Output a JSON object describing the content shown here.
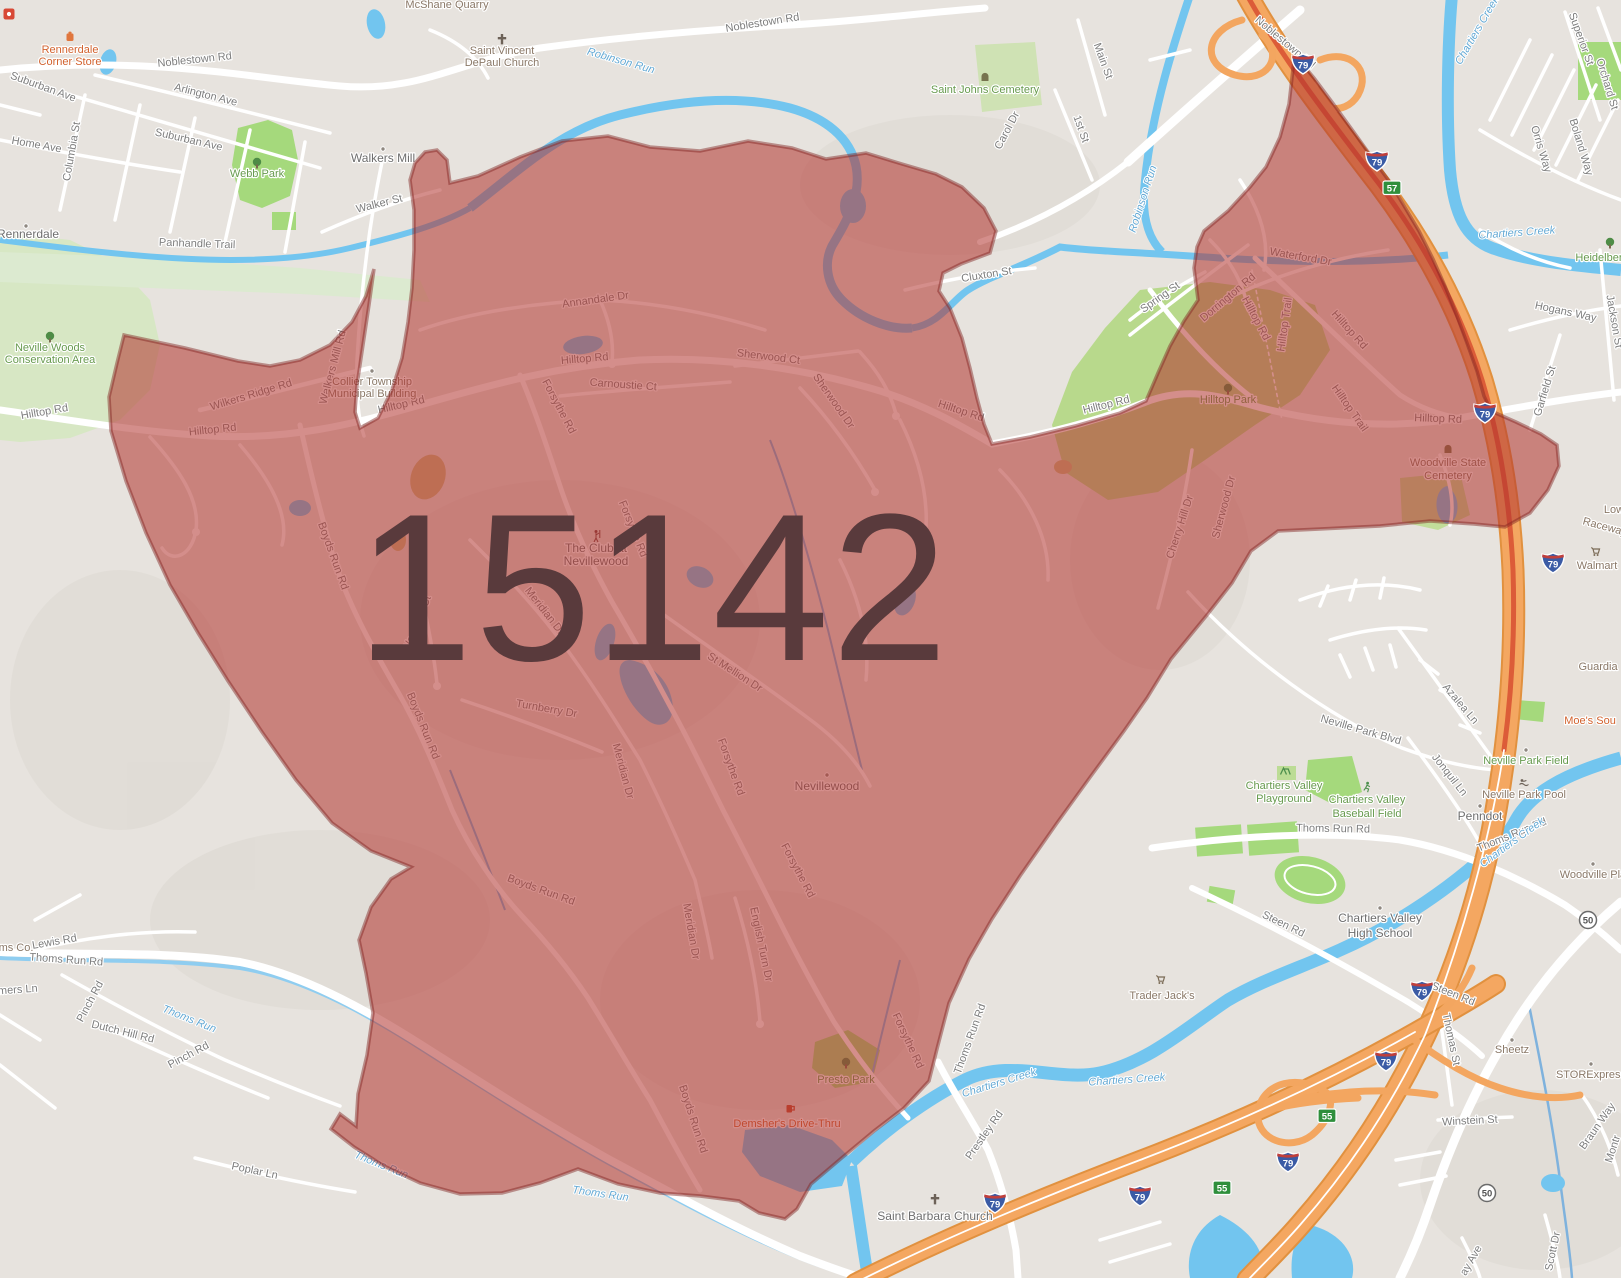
{
  "zip": {
    "code": "15142"
  },
  "colors": {
    "overlay_fill": "#b23531",
    "overlay_border": "#7e221f",
    "zip_text": "#593a3c",
    "highway_orange": "#f4a761",
    "water_blue": "#72c5ef",
    "park_green": "#a5d97c",
    "land": "#e7e3de"
  },
  "labels": {
    "shields": {
      "i79": "79",
      "exit57": "57",
      "exit55": "55",
      "route50": "50"
    },
    "roads": {
      "noblestown_w": "Noblestown Rd",
      "noblestown_c": "Noblestown Rd",
      "noblestown_ne": "Noblestown Rd",
      "arlington": "Arlington Ave",
      "suburban_1": "Suburban Ave",
      "suburban_2": "Suburban Ave",
      "home": "Home Ave",
      "columbia": "Columbia St",
      "walker": "Walker St",
      "panhandle": "Panhandle Trail",
      "carol": "Carol Dr",
      "cluxton": "Cluxton St",
      "main": "Main St",
      "first": "1st St",
      "spring": "Spring St",
      "dorrington": "Dorrington Rd",
      "superior": "Superior St",
      "orchard": "Orchard St",
      "orris": "Orris Way",
      "boland": "Boland Way",
      "hogans": "Hogans Way",
      "jackson": "Jackson St",
      "garfield": "Garfield St",
      "hilltop_w_out": "Hilltop Rd",
      "hilltop_w_in": "Hilltop Rd",
      "hilltop_mid1": "Hilltop Rd",
      "hilltop_c": "Hilltop Rd",
      "hilltop_in_e": "Hilltop Rd",
      "hilltop_notch": "Hilltop Rd",
      "hilltop_vert": "Hilltop Rd",
      "hilltop_ne_diag": "Hilltop Rd",
      "hilltop_e": "Hilltop Rd",
      "hilltop_trail_1": "Hilltop Trail",
      "hilltop_trail_2": "Hilltop Trail",
      "wilkers": "Wilkers Ridge Rd",
      "walkers_mill_rd": "Walkers Mill Rd",
      "annandale": "Annandale Dr",
      "carnoustie": "Carnoustie Ct",
      "sherwood_ct": "Sherwood Ct",
      "sherwood_dr_1": "Sherwood Dr",
      "sherwood_dr_2": "Sherwood Dr",
      "cherry_hill": "Cherry Hill Dr",
      "forsythe_1": "Forsythe Rd",
      "forsythe_2": "Forsythe Rd",
      "forsythe_3": "Forsythe Rd",
      "forsythe_4": "Forsythe Rd",
      "forsythe_5": "Forsythe Rd",
      "boyds_1": "Boyds Run Rd",
      "boyds_2": "Boyds Run Rd",
      "boyds_3": "Boyds Run Rd",
      "boyds_4": "Boyds Run Rd",
      "meridian_1": "Meridian Dr",
      "meridian_2": "Meridian Dr",
      "meridian_3": "Meridian Dr",
      "turnberry": "Turnberry Dr",
      "st_mellion": "St Mellion Dr",
      "woodhall": "Woodhall Ct",
      "english_turn": "English Turn Dr",
      "waterford": "Waterford Dr",
      "neville_park_blvd": "Neville Park Blvd",
      "azalea": "Azalea Ln",
      "jonquil": "Jonquil Ln",
      "thoms_run_rd_w": "Thoms Run Rd",
      "thoms_run_rd_s": "Thoms Run Rd",
      "thoms_run_rd_c": "Thoms Run Rd",
      "thoms_run_rd_e": "Thoms Run Rd",
      "prestley": "Prestley Rd",
      "lewis": "Lewis Rd",
      "pinch_1": "Pinch Rd",
      "pinch_2": "Pinch Rd",
      "dutch_hill": "Dutch Hill Rd",
      "poplar": "Poplar Ln",
      "mers_ln": "mers Ln",
      "steen_1": "Steen Rd",
      "steen_2": "Steen Rd",
      "thomas": "Thomas St",
      "winstein": "Winstein St",
      "braun": "Braun Way",
      "scott": "Scott Dr",
      "ay_ave": "ay Ave",
      "montr": "Montr"
    },
    "water": {
      "robinson_1": "Robinson Run",
      "robinson_2": "Robinson Run",
      "chartiers_1": "Chartiers Creek",
      "chartiers_2": "Chartiers Creek",
      "chartiers_3": "Chartiers Creek",
      "chartiers_4": "Chartiers Creek",
      "chartiers_5": "Chartiers Creek",
      "thoms_1": "Thoms Run",
      "thoms_2": "Thoms Run",
      "thoms_3": "Thoms Run"
    },
    "places": {
      "rennerdale": "Rennerdale",
      "walkers_mill": "Walkers Mill",
      "nevillewood": "Nevillewood",
      "penndot": "Penndot",
      "cv_hs_1": "Chartiers Valley",
      "cv_hs_2": "High School",
      "st_barbara": "Saint Barbara Church",
      "club_1": "The Club at",
      "club_2": "Nevillewood"
    },
    "pois": {
      "rennerdale_store_1": "Rennerdale",
      "rennerdale_store_2": "Corner Store",
      "mcshane": "McShane Quarry",
      "st_vincent_1": "Saint Vincent",
      "st_vincent_2": "DePaul Church",
      "webb_park": "Webb Park",
      "st_johns": "Saint Johns Cemetery",
      "neville_woods_1": "Neville Woods",
      "neville_woods_2": "Conservation Area",
      "collier_1": "Collier Township",
      "collier_2": "Municipal Building",
      "hilltop_park": "Hilltop Park",
      "woodville_cem_1": "Woodville State",
      "woodville_cem_2": "Cemetery",
      "presto_park": "Presto Park",
      "demshers": "Demsher's Drive-Thru",
      "trader_jacks": "Trader Jack's",
      "walmart": "Walmart",
      "raceway": "Raceway",
      "lowes": "Low",
      "guardian": "Guardia",
      "moes": "Moe's Sou",
      "woodville_plan": "Woodville Plan",
      "sheetz": "Sheetz",
      "storexpress": "STORExpress",
      "thoms_co": "ms Co.",
      "neville_field": "Neville Park Field",
      "neville_pool": "Neville Park Pool",
      "cv_playground_1": "Chartiers Valley",
      "cv_playground_2": "Playground",
      "cv_baseball_1": "Chartiers Valley",
      "cv_baseball_2": "Baseball Field",
      "heidelberg": "Heidelberg"
    }
  }
}
